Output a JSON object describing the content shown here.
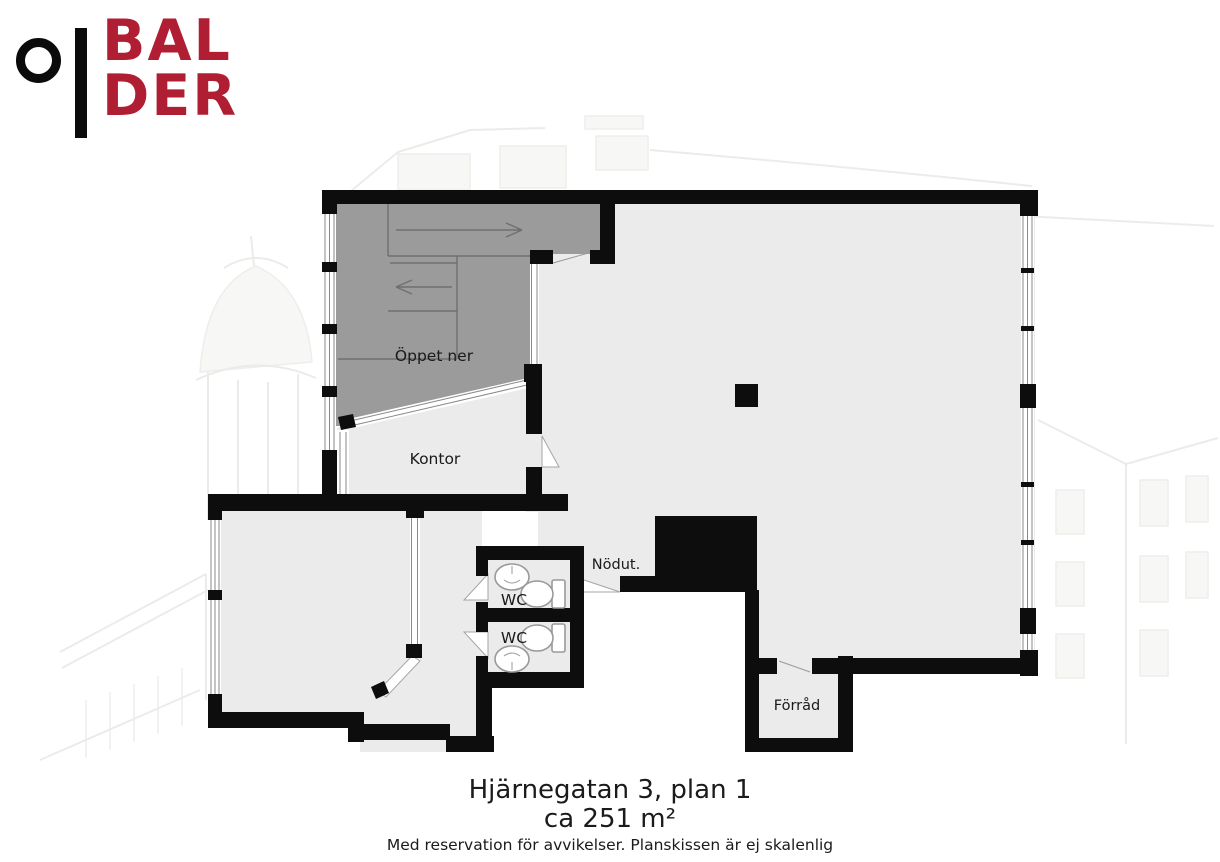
{
  "brand": {
    "line1": "BAL",
    "line2": "DER"
  },
  "plan": {
    "labels": {
      "open_below": "Öppet ner",
      "office": "Kontor",
      "wc_top": "WC",
      "wc_bottom": "WC",
      "emergency_exit": "Nödut.",
      "storage": "Förråd"
    }
  },
  "caption": {
    "address": "Hjärnegatan 3, plan 1",
    "area": "ca 251 m²",
    "disclaimer": "Med reservation för avvikelser. Planskissen är ej skalenlig"
  },
  "colors": {
    "logo_red": "#B01E33",
    "wall_black": "#0d0d0d",
    "floor_gray": "#EBEBEB",
    "stair_gray": "#9B9B9B",
    "sketch_gray": "#dcdcd8"
  }
}
